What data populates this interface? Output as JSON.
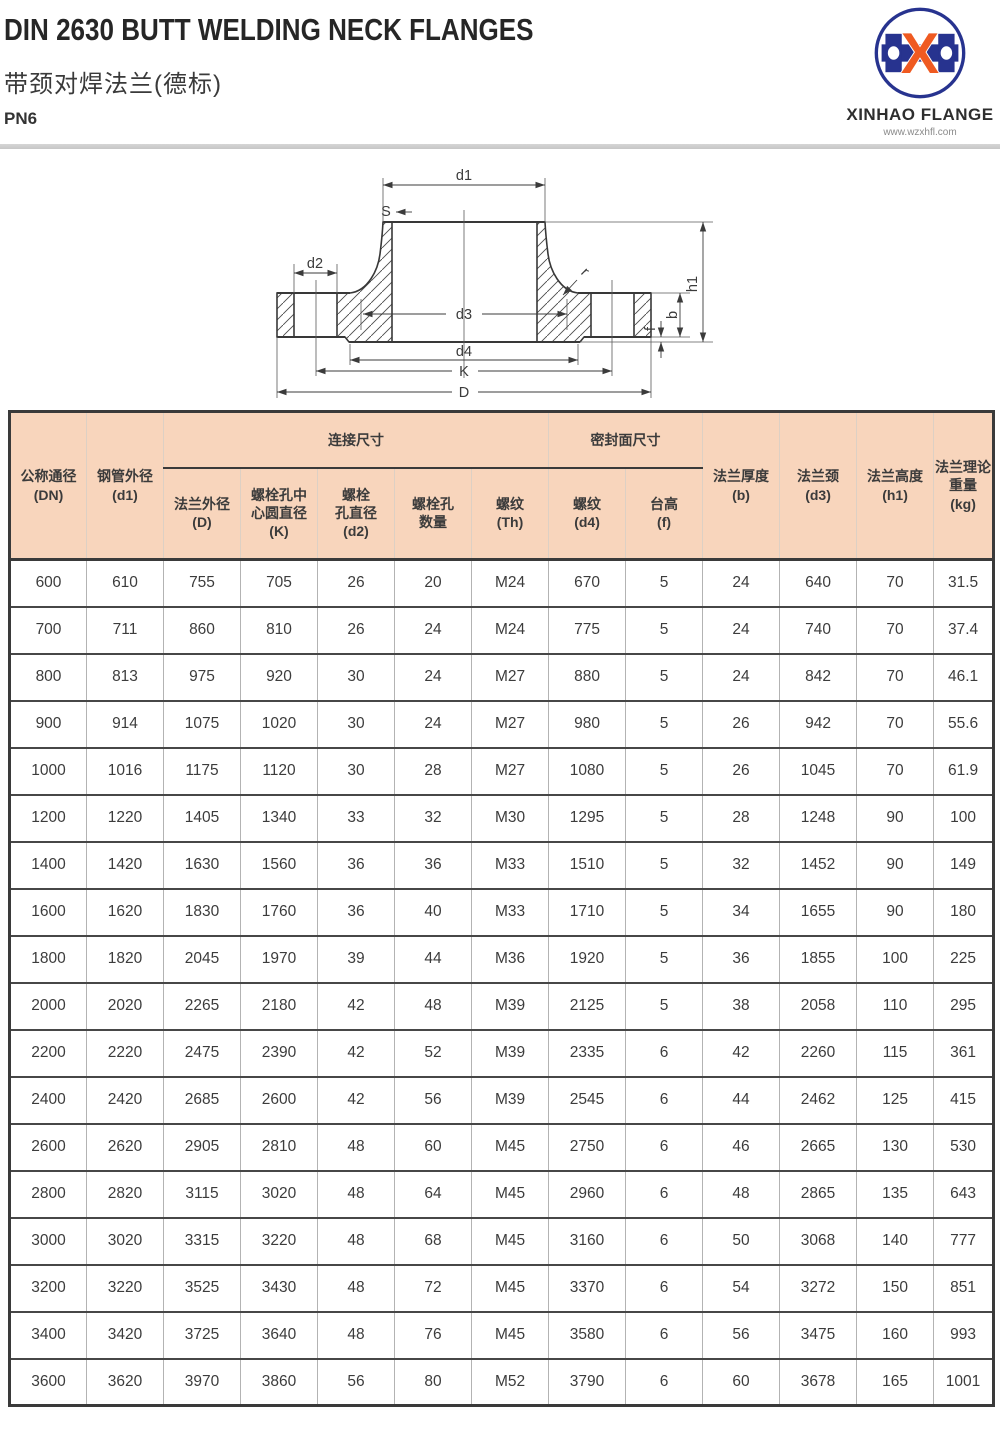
{
  "header": {
    "title_en": "DIN 2630 BUTT WELDING NECK FLANGES",
    "title_cn": "带颈对焊法兰(德标)",
    "pressure_rating": "PN6"
  },
  "logo": {
    "company": "XINHAO FLANGE",
    "website": "www.wzxhfl.com",
    "monogram": "X",
    "colors": {
      "blue": "#27338f",
      "orange": "#ef5a21"
    }
  },
  "diagram": {
    "labels": {
      "d1": "d1",
      "s": "S",
      "d2": "d2",
      "r": "r",
      "d3": "d3",
      "d4": "d4",
      "k": "K",
      "d": "D",
      "h1": "h1",
      "b": "b",
      "f": "f"
    }
  },
  "table": {
    "groups": {
      "connection": "连接尺寸",
      "sealing": "密封面尺寸"
    },
    "columns": {
      "c1": [
        "公称通径",
        "(DN)"
      ],
      "c2": [
        "钢管外径",
        "(d1)"
      ],
      "c3": [
        "法兰外径",
        "(D)"
      ],
      "c4": [
        "螺栓孔中",
        "心圆直径",
        "(K)"
      ],
      "c5": [
        "螺栓",
        "孔直径",
        "(d2)"
      ],
      "c6": [
        "螺栓孔",
        "数量"
      ],
      "c7": [
        "螺纹",
        "(Th)"
      ],
      "c8": [
        "螺纹",
        "(d4)"
      ],
      "c9": [
        "台高",
        "(f)"
      ],
      "c10": [
        "法兰厚度",
        "(b)"
      ],
      "c11": [
        "法兰颈",
        "(d3)"
      ],
      "c12": [
        "法兰高度",
        "(h1)"
      ],
      "c13": [
        "法兰理论",
        "重量",
        "(kg)"
      ]
    },
    "rows": [
      [
        "600",
        "610",
        "755",
        "705",
        "26",
        "20",
        "M24",
        "670",
        "5",
        "24",
        "640",
        "70",
        "31.5"
      ],
      [
        "700",
        "711",
        "860",
        "810",
        "26",
        "24",
        "M24",
        "775",
        "5",
        "24",
        "740",
        "70",
        "37.4"
      ],
      [
        "800",
        "813",
        "975",
        "920",
        "30",
        "24",
        "M27",
        "880",
        "5",
        "24",
        "842",
        "70",
        "46.1"
      ],
      [
        "900",
        "914",
        "1075",
        "1020",
        "30",
        "24",
        "M27",
        "980",
        "5",
        "26",
        "942",
        "70",
        "55.6"
      ],
      [
        "1000",
        "1016",
        "1175",
        "1120",
        "30",
        "28",
        "M27",
        "1080",
        "5",
        "26",
        "1045",
        "70",
        "61.9"
      ],
      [
        "1200",
        "1220",
        "1405",
        "1340",
        "33",
        "32",
        "M30",
        "1295",
        "5",
        "28",
        "1248",
        "90",
        "100"
      ],
      [
        "1400",
        "1420",
        "1630",
        "1560",
        "36",
        "36",
        "M33",
        "1510",
        "5",
        "32",
        "1452",
        "90",
        "149"
      ],
      [
        "1600",
        "1620",
        "1830",
        "1760",
        "36",
        "40",
        "M33",
        "1710",
        "5",
        "34",
        "1655",
        "90",
        "180"
      ],
      [
        "1800",
        "1820",
        "2045",
        "1970",
        "39",
        "44",
        "M36",
        "1920",
        "5",
        "36",
        "1855",
        "100",
        "225"
      ],
      [
        "2000",
        "2020",
        "2265",
        "2180",
        "42",
        "48",
        "M39",
        "2125",
        "5",
        "38",
        "2058",
        "110",
        "295"
      ],
      [
        "2200",
        "2220",
        "2475",
        "2390",
        "42",
        "52",
        "M39",
        "2335",
        "6",
        "42",
        "2260",
        "115",
        "361"
      ],
      [
        "2400",
        "2420",
        "2685",
        "2600",
        "42",
        "56",
        "M39",
        "2545",
        "6",
        "44",
        "2462",
        "125",
        "415"
      ],
      [
        "2600",
        "2620",
        "2905",
        "2810",
        "48",
        "60",
        "M45",
        "2750",
        "6",
        "46",
        "2665",
        "130",
        "530"
      ],
      [
        "2800",
        "2820",
        "3115",
        "3020",
        "48",
        "64",
        "M45",
        "2960",
        "6",
        "48",
        "2865",
        "135",
        "643"
      ],
      [
        "3000",
        "3020",
        "3315",
        "3220",
        "48",
        "68",
        "M45",
        "3160",
        "6",
        "50",
        "3068",
        "140",
        "777"
      ],
      [
        "3200",
        "3220",
        "3525",
        "3430",
        "48",
        "72",
        "M45",
        "3370",
        "6",
        "54",
        "3272",
        "150",
        "851"
      ],
      [
        "3400",
        "3420",
        "3725",
        "3640",
        "48",
        "76",
        "M45",
        "3580",
        "6",
        "56",
        "3475",
        "160",
        "993"
      ],
      [
        "3600",
        "3620",
        "3970",
        "3860",
        "56",
        "80",
        "M52",
        "3790",
        "6",
        "60",
        "3678",
        "165",
        "1001"
      ]
    ]
  }
}
